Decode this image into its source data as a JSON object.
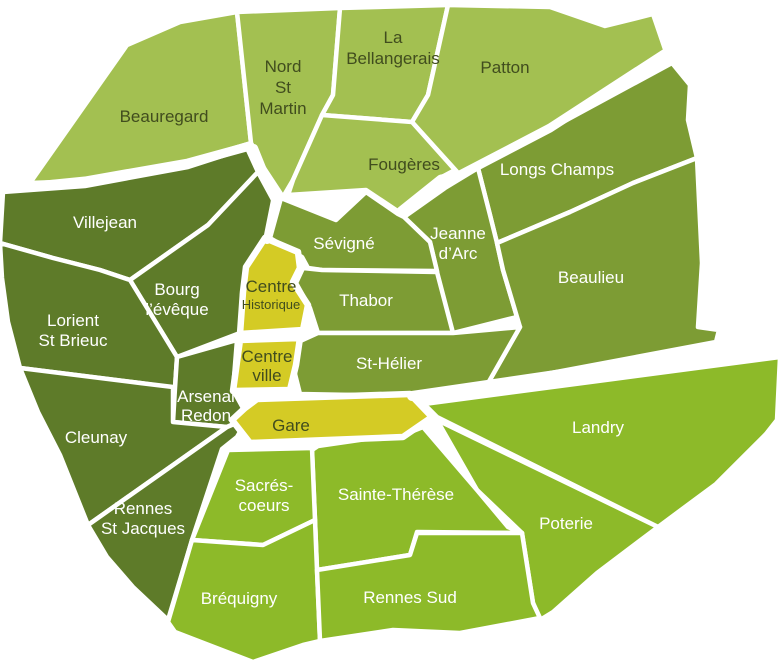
{
  "canvas": {
    "width": 784,
    "height": 667,
    "background": "#ffffff"
  },
  "palette": {
    "light": "#a3c051",
    "medium": "#7d9c34",
    "dark": "#5e7b29",
    "bright": "#8dba29",
    "yellow": "#d4cb25",
    "border": "#ffffff",
    "label_dark": "#414d1e",
    "label_light": "#ffffff"
  },
  "regions": [
    {
      "id": "beauregard",
      "name": "Beauregard",
      "fill": "light",
      "stroke_width": 4.5,
      "points": "30,183 127,45 180,22 237,12 251,143 188,162 85,181",
      "label": {
        "x": 164,
        "color": "label_dark",
        "lines": [
          {
            "text": "Beauregard",
            "y": 122,
            "size": 17
          }
        ]
      }
    },
    {
      "id": "nord-st-martin",
      "name": "Nord St Martin",
      "fill": "light",
      "stroke_width": 4.5,
      "points": "237,12 340,8 333,95 322,115 293,180 283,197 262,165 251,143",
      "label": {
        "x": 283,
        "color": "label_dark",
        "lines": [
          {
            "text": "Nord",
            "y": 72,
            "size": 17
          },
          {
            "text": "St",
            "y": 93,
            "size": 17
          },
          {
            "text": "Martin",
            "y": 114,
            "size": 17
          }
        ]
      }
    },
    {
      "id": "la-bellangerais",
      "name": "La Bellangerais",
      "fill": "light",
      "stroke_width": 4.5,
      "points": "340,8 448,5 428,95 412,122 322,115 333,95",
      "label": {
        "x": 393,
        "color": "label_dark",
        "lines": [
          {
            "text": "La",
            "y": 43,
            "size": 17
          },
          {
            "text": "Bellangerais",
            "y": 64,
            "size": 17
          }
        ]
      }
    },
    {
      "id": "patton",
      "name": "Patton",
      "fill": "light",
      "stroke_width": 4.5,
      "points": "448,5 550,7 605,26 653,14 666,52 550,128 460,175 412,122 428,95",
      "label": {
        "x": 505,
        "color": "label_dark",
        "lines": [
          {
            "text": "Patton",
            "y": 73,
            "size": 17
          }
        ]
      }
    },
    {
      "id": "fougeres",
      "name": "Fougères",
      "fill": "light",
      "stroke_width": 4.5,
      "points": "322,115 412,122 455,170 440,178 399,212 366,190 288,195 293,180",
      "label": {
        "x": 404,
        "color": "label_dark",
        "lines": [
          {
            "text": "Fougères",
            "y": 170,
            "size": 17
          }
        ]
      }
    },
    {
      "id": "villejean",
      "name": "Villejean",
      "fill": "dark",
      "stroke_width": 4.5,
      "points": "3,192 85,186 188,167 247,148 258,172 208,225 130,280 100,270 53,258 0,243",
      "label": {
        "x": 105,
        "color": "label_light",
        "lines": [
          {
            "text": "Villejean",
            "y": 228,
            "size": 17
          }
        ]
      }
    },
    {
      "id": "longs-champs",
      "name": "Longs Champs",
      "fill": "medium",
      "stroke_width": 4.5,
      "points": "478,168 672,63 690,85 688,120 697,158 633,183 570,212 497,243 490,215",
      "label": {
        "x": 557,
        "color": "label_light",
        "lines": [
          {
            "text": "Longs Champs",
            "y": 175,
            "size": 17
          }
        ]
      }
    },
    {
      "id": "jeanne-darc",
      "name": "Jeanne d’Arc",
      "fill": "medium",
      "stroke_width": 4.5,
      "points": "404,217 445,188 478,168 490,215 497,243 503,270 517,317 453,333 438,310 437,272 430,242",
      "label": {
        "x": 458,
        "color": "label_light",
        "lines": [
          {
            "text": "Jeanne",
            "y": 239,
            "size": 17
          },
          {
            "text": "d’Arc",
            "y": 259,
            "size": 17
          }
        ]
      }
    },
    {
      "id": "beaulieu",
      "name": "Beaulieu",
      "fill": "medium",
      "stroke_width": 4.5,
      "points": "497,243 570,212 633,183 697,158 702,263 698,327 719,330 716,342 487,385 520,327 517,317 503,270",
      "label": {
        "x": 591,
        "color": "label_light",
        "lines": [
          {
            "text": "Beaulieu",
            "y": 283,
            "size": 17
          }
        ]
      }
    },
    {
      "id": "sevigne",
      "name": "Sévigné",
      "fill": "medium",
      "stroke_width": 4.5,
      "points": "281,198 336,220 366,192 398,214 404,217 430,242 437,271 322,270 308,268 302,257 270,238",
      "label": {
        "x": 344,
        "color": "label_light",
        "lines": [
          {
            "text": "Sévigné",
            "y": 249,
            "size": 17
          }
        ]
      }
    },
    {
      "id": "thabor",
      "name": "Thabor",
      "fill": "medium",
      "stroke_width": 4.5,
      "points": "303,268 322,270 437,272 453,333 318,333 310,308 296,283",
      "label": {
        "x": 366,
        "color": "label_light",
        "lines": [
          {
            "text": "Thabor",
            "y": 306,
            "size": 17
          }
        ]
      }
    },
    {
      "id": "st-helier",
      "name": "St-Hélier",
      "fill": "medium",
      "stroke_width": 4.5,
      "points": "296,343 318,333 453,333 520,327 487,385 412,396 300,394 293,366",
      "label": {
        "x": 389,
        "color": "label_light",
        "lines": [
          {
            "text": "St-Hélier",
            "y": 369,
            "size": 17
          }
        ]
      }
    },
    {
      "id": "bourg-leveque",
      "name": "Bourg l’évêque",
      "fill": "dark",
      "stroke_width": 4.5,
      "points": "258,172 277,207 267,240 246,267 242,295 240,333 177,357 130,280 208,225",
      "label": {
        "x": 177,
        "color": "label_light",
        "lines": [
          {
            "text": "Bourg",
            "y": 295,
            "size": 17
          },
          {
            "text": "l’évêque",
            "y": 315,
            "size": 17
          }
        ]
      }
    },
    {
      "id": "lorient-st-brieuc",
      "name": "Lorient St Brieuc",
      "fill": "dark",
      "stroke_width": 4.5,
      "points": "0,243 53,258 100,270 130,280 177,357 175,388 140,383 20,368 8,322 2,278",
      "label": {
        "x": 73,
        "color": "label_light",
        "lines": [
          {
            "text": "Lorient",
            "y": 326,
            "size": 17
          },
          {
            "text": "St Brieuc",
            "y": 346,
            "size": 17
          }
        ]
      }
    },
    {
      "id": "arsenal-redon",
      "name": "Arsenal Redon",
      "fill": "dark",
      "stroke_width": 4.5,
      "points": "177,357 237,340 233,390 248,417 227,427 173,422 175,388",
      "label": {
        "x": 206,
        "color": "label_light",
        "lines": [
          {
            "text": "Arsenal",
            "y": 402,
            "size": 17
          },
          {
            "text": "Redon",
            "y": 421,
            "size": 17
          }
        ]
      }
    },
    {
      "id": "cleunay",
      "name": "Cleunay",
      "fill": "dark",
      "stroke_width": 4.5,
      "points": "20,368 140,383 173,387 173,422 227,427 88,525 60,455 38,412",
      "label": {
        "x": 96,
        "color": "label_light",
        "lines": [
          {
            "text": "Cleunay",
            "y": 443,
            "size": 17
          }
        ]
      }
    },
    {
      "id": "rennes-st-jacques",
      "name": "Rennes St Jacques",
      "fill": "dark",
      "stroke_width": 4.5,
      "points": "227,427 248,418 237,437 222,449 192,540 168,620 133,587 107,557 88,525",
      "label": {
        "x": 143,
        "color": "label_light",
        "lines": [
          {
            "text": "Rennes",
            "y": 514,
            "size": 17
          },
          {
            "text": "St Jacques",
            "y": 534,
            "size": 17
          }
        ]
      }
    },
    {
      "id": "landry",
      "name": "Landry",
      "fill": "bright",
      "stroke_width": 4.5,
      "points": "424,404 780,357 777,420 766,434 716,484 658,527 437,417",
      "label": {
        "x": 598,
        "color": "label_light",
        "lines": [
          {
            "text": "Landry",
            "y": 433,
            "size": 17
          }
        ]
      }
    },
    {
      "id": "poterie",
      "name": "Poterie",
      "fill": "bright",
      "stroke_width": 4.5,
      "points": "437,420 658,527 597,573 553,612 540,620 533,603 522,533 477,490",
      "label": {
        "x": 566,
        "color": "label_light",
        "lines": [
          {
            "text": "Poterie",
            "y": 529,
            "size": 17
          }
        ]
      }
    },
    {
      "id": "sainte-therese",
      "name": "Sainte-Thérèse",
      "fill": "bright",
      "stroke_width": 4.5,
      "points": "312,450 318,446 408,433 423,427 477,490 508,527 522,533 417,532 410,555 317,570 315,520",
      "label": {
        "x": 396,
        "color": "label_light",
        "lines": [
          {
            "text": "Sainte-Thérèse",
            "y": 500,
            "size": 17
          }
        ]
      }
    },
    {
      "id": "sacres-coeurs",
      "name": "Sacrés-coeurs",
      "fill": "bright",
      "stroke_width": 4.5,
      "points": "228,450 312,448 315,520 263,545 192,540",
      "label": {
        "x": 264,
        "color": "label_light",
        "lines": [
          {
            "text": "Sacrés-",
            "y": 491,
            "size": 17
          },
          {
            "text": "coeurs",
            "y": 511,
            "size": 17
          }
        ]
      }
    },
    {
      "id": "brequigny",
      "name": "Bréquigny",
      "fill": "bright",
      "stroke_width": 4.5,
      "points": "192,540 263,545 315,520 317,570 320,641 303,645 253,662 175,632 168,622",
      "label": {
        "x": 239,
        "color": "label_light",
        "lines": [
          {
            "text": "Bréquigny",
            "y": 604,
            "size": 17
          }
        ]
      }
    },
    {
      "id": "rennes-sud",
      "name": "Rennes Sud",
      "fill": "bright",
      "stroke_width": 4.5,
      "points": "317,570 410,555 417,533 522,533 533,603 540,618 460,633 393,630 320,641",
      "label": {
        "x": 410,
        "color": "label_light",
        "lines": [
          {
            "text": "Rennes Sud",
            "y": 603,
            "size": 17
          }
        ]
      }
    },
    {
      "id": "centre-historique",
      "name": "Centre Historique",
      "fill": "yellow",
      "stroke_width": 6.5,
      "points": "265,238 298,252 300,268 293,282 308,305 303,330 240,334 243,292 246,267",
      "label": {
        "x": 271,
        "color": "label_dark",
        "lines": [
          {
            "text": "Centre",
            "y": 292,
            "size": 17
          },
          {
            "text": "Historique",
            "y": 309,
            "size": 13
          }
        ]
      }
    },
    {
      "id": "centre-ville",
      "name": "Centre ville",
      "fill": "yellow",
      "stroke_width": 6.5,
      "points": "240,340 300,338 296,365 290,390 233,391",
      "label": {
        "x": 267,
        "color": "label_dark",
        "lines": [
          {
            "text": "Centre",
            "y": 362,
            "size": 17
          },
          {
            "text": "ville",
            "y": 381,
            "size": 17
          }
        ]
      }
    },
    {
      "id": "gare",
      "name": "Gare",
      "fill": "yellow",
      "stroke_width": 6.5,
      "points": "232,420 245,408 257,399 410,394 432,417 403,437 250,443",
      "label": {
        "x": 291,
        "color": "label_dark",
        "lines": [
          {
            "text": "Gare",
            "y": 431,
            "size": 17
          }
        ]
      }
    }
  ],
  "bands": [
    {
      "id": "band-beauregard-villejean",
      "points": "25,187 85,181 188,163 250,146",
      "width": 9
    },
    {
      "id": "band-nordstmartin-centre",
      "points": "254,148 275,200 267,240",
      "width": 8
    },
    {
      "id": "band-patton-longschamps",
      "points": "664,54 550,128 458,176 441,179 401,211",
      "width": 9
    },
    {
      "id": "band-beaulieu-landry",
      "points": "781,342 412,396",
      "width": 10
    }
  ]
}
